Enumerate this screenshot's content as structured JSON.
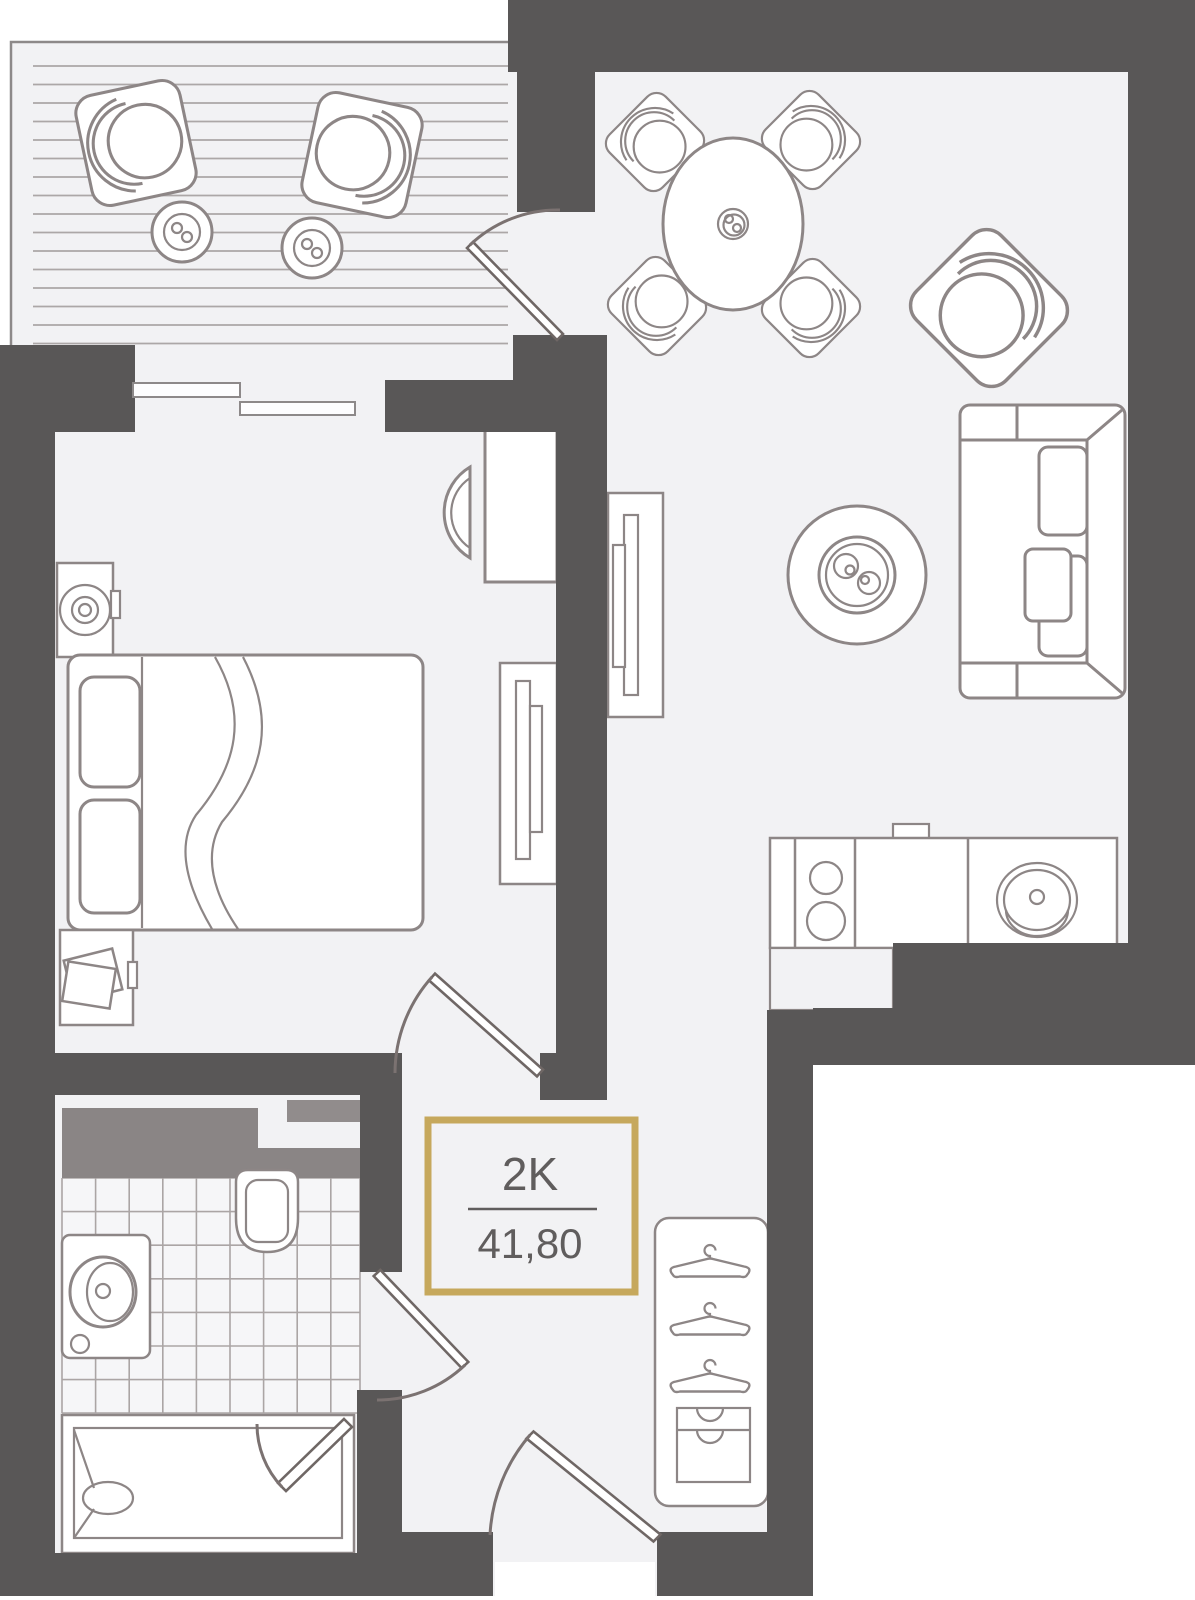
{
  "plan_label": {
    "unit_type": "2K",
    "area": "41,80"
  },
  "style": {
    "accent_gold": "#C6A85C",
    "wall_color": "#595757",
    "floor_color": "#F2F2F4",
    "furniture_line_color": "#8D8686",
    "shaft_color": "#8A8585",
    "door_line_color": "#6F6765",
    "label_text_color": "#605D5D"
  },
  "rooms": {
    "balcony": {
      "symbols": [
        "deck-flooring",
        "lounge-chair",
        "lounge-chair",
        "side-table-with-cup",
        "side-table-with-cup"
      ]
    },
    "living_room": {
      "symbols": [
        "round-dining-table",
        "dining-chair",
        "dining-chair",
        "dining-chair",
        "dining-chair",
        "cup",
        "armchair",
        "sofa-with-cushions",
        "round-coffee-table-with-cups"
      ]
    },
    "kitchen": {
      "symbols": [
        "countertop",
        "two-burner-stove",
        "cooker-hood",
        "round-sink",
        "counter-return"
      ]
    },
    "bedroom": {
      "symbols": [
        "double-bed",
        "pillow",
        "pillow",
        "blanket-fold",
        "nightstand-with-lamp",
        "nightstand-with-books",
        "desk",
        "desk-chair",
        "sliding-wardrobe",
        "sliding-wardrobe",
        "window",
        "window"
      ]
    },
    "bathroom": {
      "symbols": [
        "ventilation-shaft",
        "tiled-floor",
        "toilet",
        "washbasin-cabinet",
        "bathtub",
        "tub-screen-door"
      ]
    },
    "hallway": {
      "symbols": [
        "open-closet-with-hangers",
        "hanger",
        "hanger",
        "hanger",
        "drawer-unit"
      ]
    },
    "doors": {
      "symbols": [
        "balcony-door-swing",
        "bedroom-door-swing",
        "bathroom-door-swing",
        "entrance-door-swing"
      ]
    }
  }
}
